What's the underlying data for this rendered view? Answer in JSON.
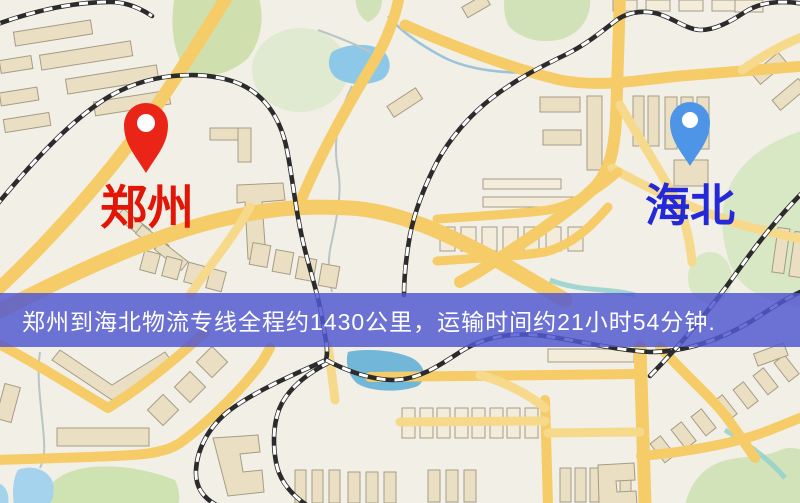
{
  "page": {
    "width": 800,
    "height": 503,
    "kind": "logistics-route-map"
  },
  "map": {
    "markers": [
      {
        "id": "origin",
        "label": "郑州",
        "pin_color": "#ea2517",
        "hole_color": "#ffffff",
        "label_color": "#e21507"
      },
      {
        "id": "destination",
        "label": "海北",
        "pin_color": "#4e95e8",
        "hole_color": "#ffffff",
        "label_color": "#2328d8"
      }
    ],
    "banner": {
      "text": "郑州到海北物流专线全程约1430公里，运输时间约21小时54分钟.",
      "bg_color": "#5258d0",
      "text_color": "#ffffff"
    },
    "palette": {
      "land": "#f2efe6",
      "road": "#f5cc67",
      "building": "#eadfc2",
      "park": "#d4e4b5",
      "water": "#8ec8e8",
      "railway": "#2b2b2b"
    }
  }
}
